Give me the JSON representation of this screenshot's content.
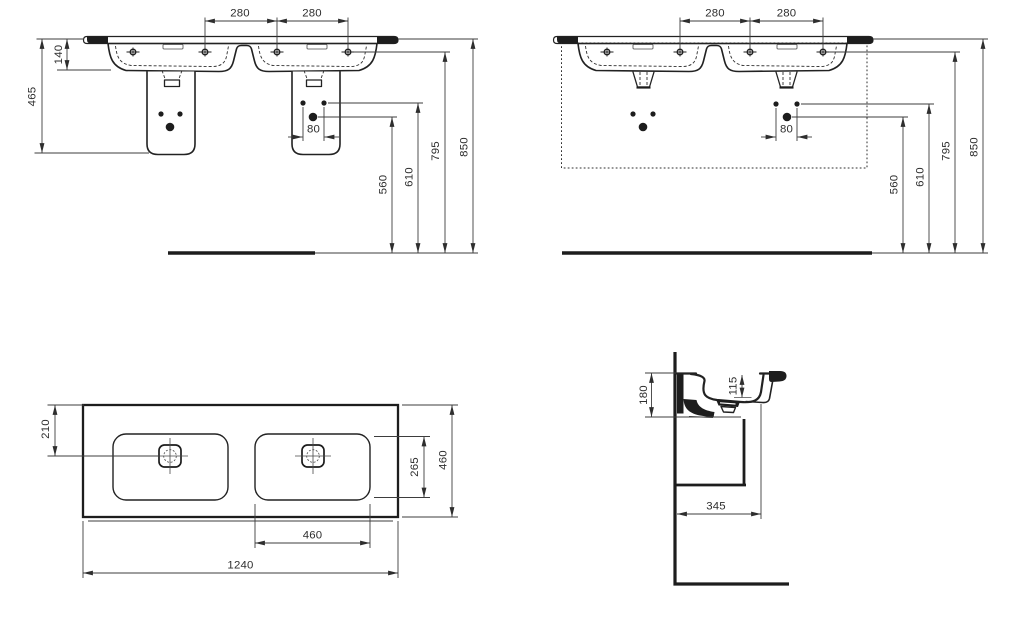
{
  "colors": {
    "line": "#222222",
    "dim_line": "#3d3d3d",
    "text": "#2e2e2e",
    "background": "#ffffff"
  },
  "views": {
    "front_pedestal": {
      "title": "front view with trap covers",
      "dims": {
        "tap_span_left": "280",
        "tap_span_right": "280",
        "rim_height": "140",
        "basin_overall_height": "465",
        "fixing_hole_spacing": "80",
        "trap_height": "560",
        "fixing_height": "610",
        "tap_deck_height": "795",
        "rim_top_height": "850"
      }
    },
    "front_furniture": {
      "title": "front view with furniture outline",
      "dims": {
        "tap_span_left": "280",
        "tap_span_right": "280",
        "fixing_hole_spacing": "80",
        "trap_height": "560",
        "fixing_height": "610",
        "tap_deck_height": "795",
        "rim_top_height": "850"
      }
    },
    "plan": {
      "title": "plan view",
      "dims": {
        "back_to_drain": "210",
        "bowl_front_back": "265",
        "total_depth": "460",
        "bowl_width": "460",
        "total_width": "1240"
      }
    },
    "side": {
      "title": "side section view",
      "dims": {
        "front_edge_height": "180",
        "bowl_inner_depth": "115",
        "projection": "345"
      }
    }
  }
}
